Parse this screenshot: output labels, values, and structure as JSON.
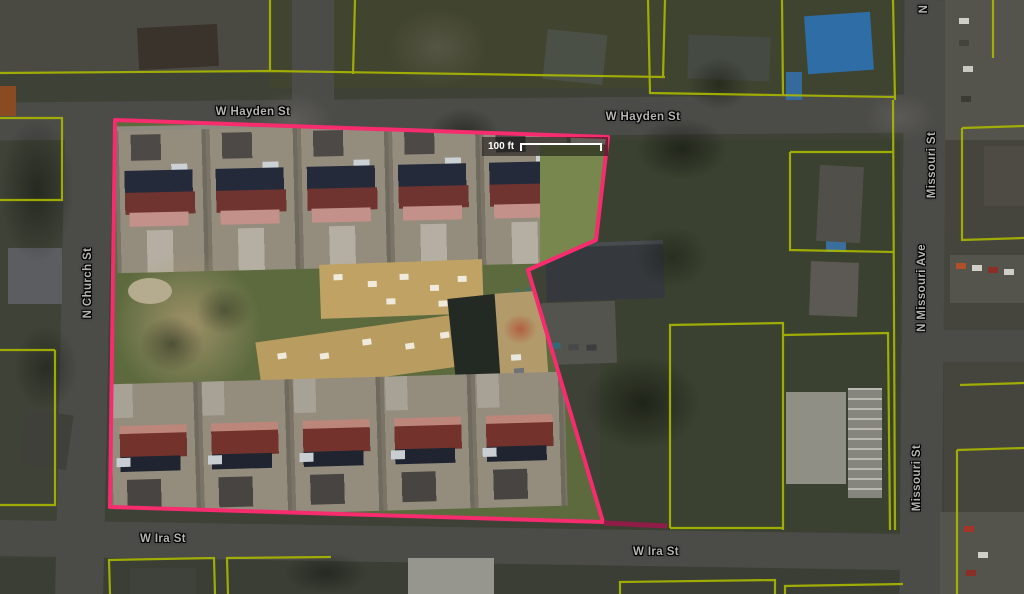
{
  "map": {
    "type": "aerial-parcel-view",
    "street_labels": [
      {
        "text": "W Hayden St",
        "orientation": "horizontal"
      },
      {
        "text": "W Hayden St",
        "orientation": "horizontal"
      },
      {
        "text": "W Ira St",
        "orientation": "horizontal"
      },
      {
        "text": "W Ira St",
        "orientation": "horizontal"
      },
      {
        "text": "N Church St",
        "orientation": "vertical"
      },
      {
        "text": "Missouri St",
        "orientation": "vertical"
      },
      {
        "text": "N Missouri Ave",
        "orientation": "vertical"
      },
      {
        "text": "Missouri St",
        "orientation": "vertical"
      },
      {
        "text": "N",
        "orientation": "vertical"
      }
    ],
    "scale_bar": {
      "label": "100 ft"
    },
    "colors": {
      "selection_outline": "#f72c6e",
      "selection_outline_dim": "#8f1d47",
      "parcel_line": "#aab800"
    }
  }
}
